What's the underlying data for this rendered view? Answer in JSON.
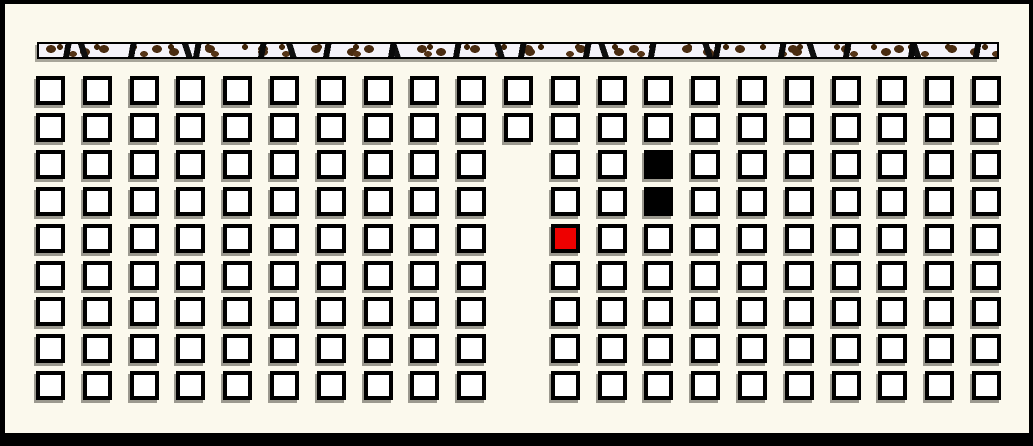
{
  "scene": {
    "description": "Grid seating view with textured front wall strip, two occupied (black) seats and one selected (red) seat",
    "background_color": "#FBF9ED",
    "frame_color": "#000000"
  },
  "wall_bar": {
    "name": "front-wall-strip",
    "base_color": "#F5F3F9",
    "speckle_color": "#4A2C11",
    "dash_color": "#0A0A0A",
    "border_color": "#000000"
  },
  "grid": {
    "rows": 9,
    "columns": 21,
    "origin": {
      "x": 36,
      "y": 76
    },
    "spacing": {
      "x": 46.8,
      "y": 36.9
    },
    "cell_size": 29,
    "cell_border_color": "#000000",
    "shadow_color": "#9B998F",
    "full_width_rows": [
      1,
      2
    ],
    "aisle": {
      "column": 11,
      "rows_from": 3,
      "rows_to": 9
    },
    "states": {
      "empty": {
        "fill": "#FFFFFF"
      },
      "occupied": {
        "fill": "#000000"
      },
      "selected": {
        "fill": "#EE0000"
      }
    },
    "special_cells": [
      {
        "row": 3,
        "column": 14,
        "state": "occupied"
      },
      {
        "row": 4,
        "column": 14,
        "state": "occupied"
      },
      {
        "row": 5,
        "column": 12,
        "state": "selected"
      }
    ]
  }
}
